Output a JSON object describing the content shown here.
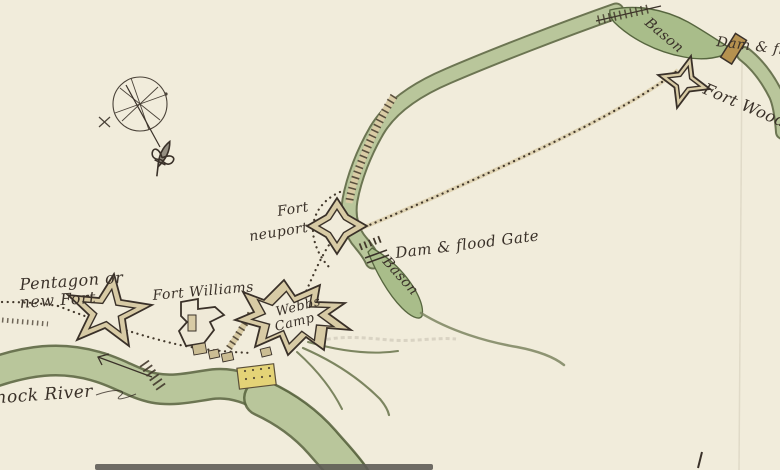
{
  "map": {
    "kind": "hand-drawn-manuscript-fort-map",
    "labels": {
      "pentagon_fort_line1": "Pentagon or",
      "pentagon_fort_line2": "new Fort",
      "fort_williams": "Fort Williams",
      "webbs_camp_line1": "Webbs",
      "webbs_camp_line2": "Camp",
      "fort_newport_line1": "Fort",
      "fort_newport_line2": "neuport",
      "dam_flood_gate_mid": "Dam & flood Gate",
      "bason_mid": "Bason",
      "bason_top": "Bason",
      "dam_flood_gate_top": "Dam & flo",
      "fort_wood_creek": "Fort Wood",
      "mohawk_river": "hock River"
    },
    "icons": {
      "compass_rose_icon": "compass wheel with needle",
      "fleur_de_lis_icon": "⚜"
    },
    "colors": {
      "paper": "#f1ecdb",
      "river_fill": "#b9c69b",
      "river_edge": "#5d6843",
      "basin_fill": "#a9bd8a",
      "ink": "#3a3129",
      "road_fill": "#d9cba4",
      "fort_fill": "#d8cba5",
      "building_yellow": "#e4d377",
      "dam_brown": "#b5914f"
    }
  }
}
